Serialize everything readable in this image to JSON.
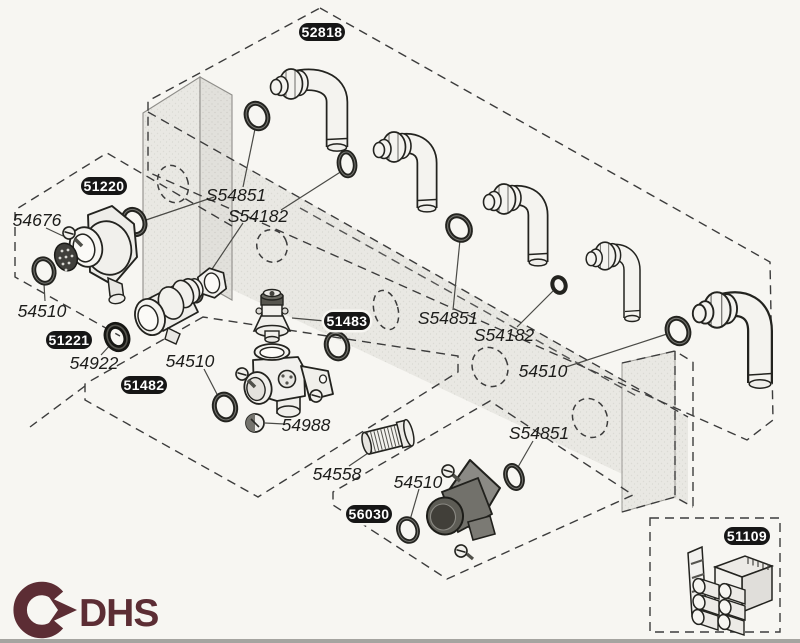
{
  "badges": {
    "b52818": "52818",
    "b51220": "51220",
    "b51221": "51221",
    "b51482": "51482",
    "b51483": "51483",
    "b56030": "56030",
    "b51109": "51109"
  },
  "labels": {
    "n54676": "54676",
    "n54510_left": "54510",
    "n54922": "54922",
    "n54510_mid_left": "54510",
    "s54851_top": "S54851",
    "s54182_top": "S54182",
    "s54851_mid": "S54851",
    "s54182_mid": "S54182",
    "n54510_mid_right": "54510",
    "n54988": "54988",
    "n54558": "54558",
    "n54510_bottom": "54510",
    "s54851_bottom": "S54851"
  },
  "logo": {
    "text": "DHS"
  },
  "colors": {
    "logo": "#5c2d34",
    "ink": "#23231f",
    "panel": "#e9e8e3",
    "badge_bg": "#161616",
    "badge_text": "#ffffff",
    "background": "#f7f6f2"
  }
}
